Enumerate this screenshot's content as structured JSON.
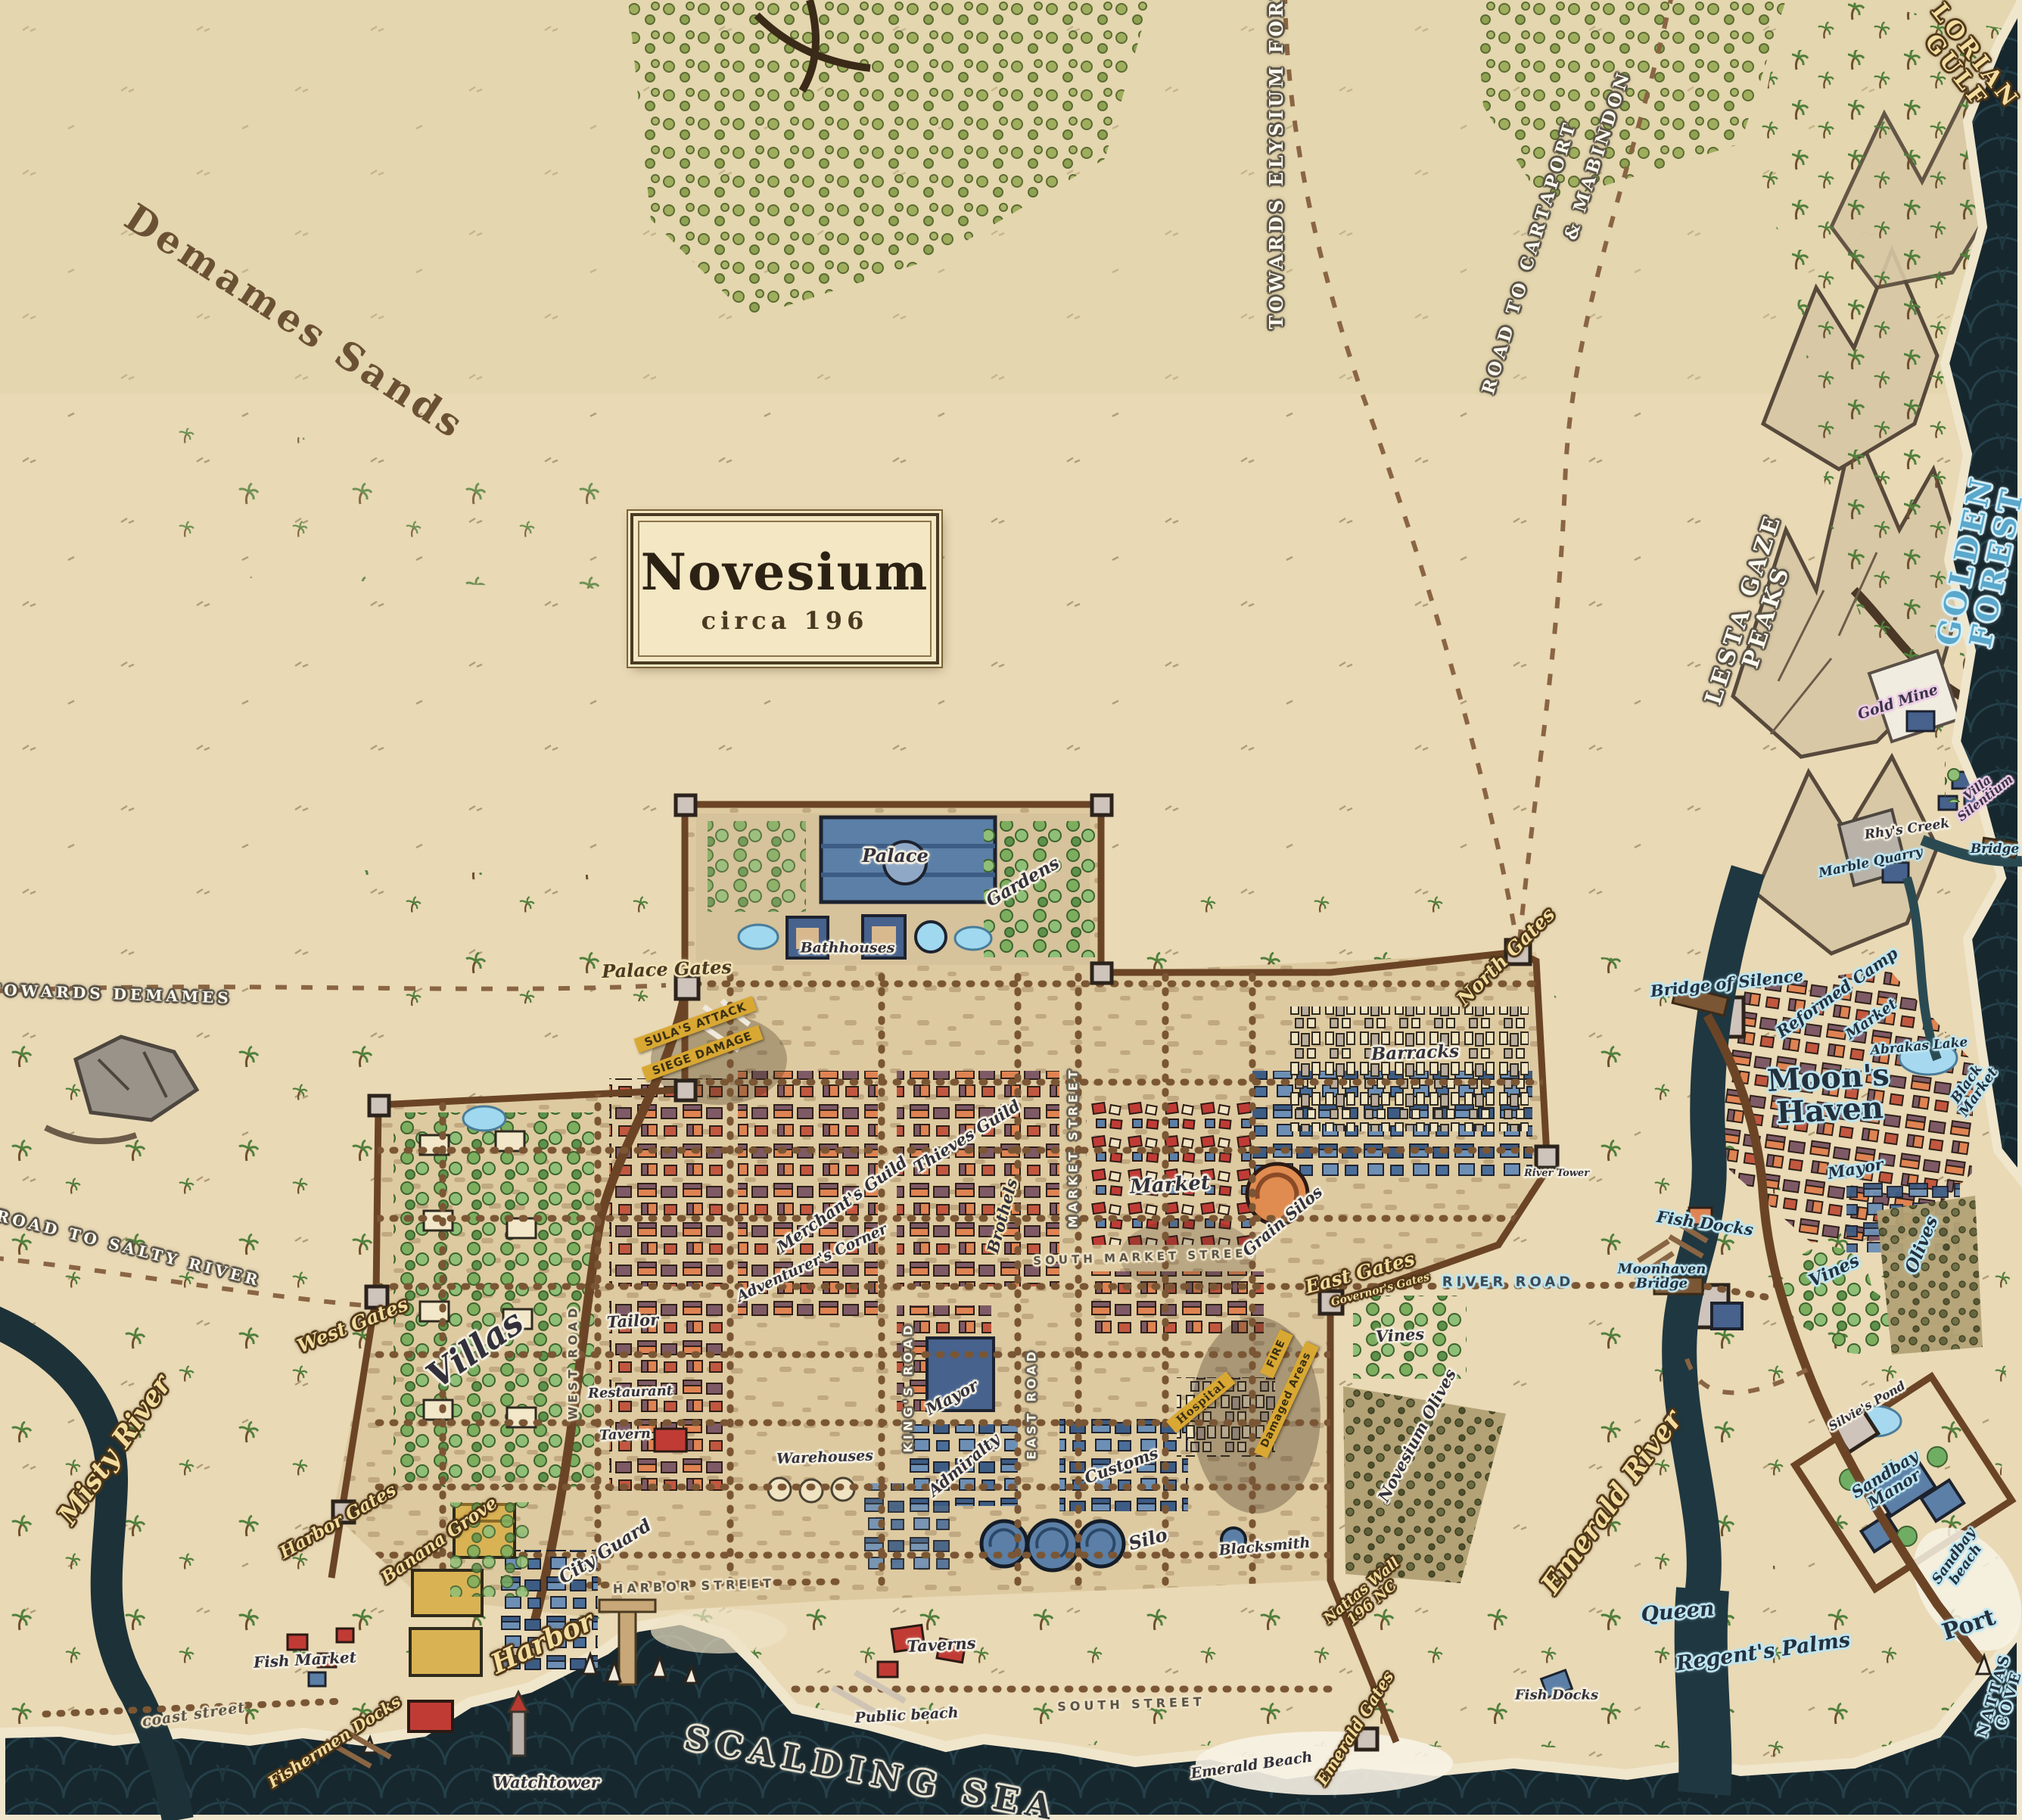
{
  "title": {
    "name": "Novesium",
    "subtitle": "circa 196"
  },
  "labels": {
    "demames_sands": {
      "text": "Demames Sands"
    },
    "lorian_gulf": {
      "text": "LORIAN GULF"
    },
    "towards_elysium": {
      "text": "TOWARDS ELYSIUM FORT"
    },
    "road_cartaport": {
      "text": "ROAD TO CARTAPORT"
    },
    "road_mabindon": {
      "text": "& MABINDON"
    },
    "lesta_gaze_peaks": {
      "text": "LESTA GAZE PEAKS"
    },
    "golden_forest": {
      "text": "GOLDEN FOREST"
    },
    "gold_mine": {
      "text": "Gold Mine"
    },
    "villa_silentium": {
      "text": "Villa Silentium"
    },
    "rhys_creek": {
      "text": "Rhy's Creek"
    },
    "marble_quarry": {
      "text": "Marble Quarry"
    },
    "bridge_ne": {
      "text": "Bridge"
    },
    "bridge_of_silence": {
      "text": "Bridge of Silence"
    },
    "reformed_camp": {
      "text": "Reformed Camp"
    },
    "market_moons_haven": {
      "text": "Market"
    },
    "abrakas_lake": {
      "text": "Abrakas Lake"
    },
    "moons_haven": {
      "text": "Moon's Haven"
    },
    "black_market": {
      "text": "Black Market"
    },
    "river_tower": {
      "text": "River Tower"
    },
    "mayor_moons_haven": {
      "text": "Mayor"
    },
    "fish_docks_east": {
      "text": "Fish Docks"
    },
    "moonhaven_bridge": {
      "text": "Moonhaven\nBridge"
    },
    "vines_moons_haven": {
      "text": "Vines"
    },
    "olives_moons_haven": {
      "text": "Olives"
    },
    "river_road": {
      "text": "RIVER ROAD"
    },
    "silvies_pond": {
      "text": "Silvie's Pond"
    },
    "sandbay_manor": {
      "text": "Sandbay Manor"
    },
    "sandbay_beach": {
      "text": "Sandbay beach"
    },
    "port": {
      "text": "Port"
    },
    "nattas_cove": {
      "text": "NATTAS COVE"
    },
    "emerald_river": {
      "text": "Emerald River"
    },
    "queen_palms_line1": {
      "text": "Queen"
    },
    "queen_palms_line2": {
      "text": "Regent's Palms"
    },
    "fish_docks_south": {
      "text": "Fish Docks"
    },
    "misty_river": {
      "text": "Misty River"
    },
    "road_salty_river": {
      "text": "ROAD TO SALTY RIVER"
    },
    "towards_demames": {
      "text": "TOWARDS DEMAMES"
    },
    "west_gates": {
      "text": "West Gates"
    },
    "harbor_gates": {
      "text": "Harbor Gates"
    },
    "banana_grove": {
      "text": "Banana Grove"
    },
    "fish_market": {
      "text": "Fish Market"
    },
    "coast_street": {
      "text": "coast street"
    },
    "fishermen_docks": {
      "text": "Fishermen Docks"
    },
    "watchtower": {
      "text": "Watchtower"
    },
    "harbor": {
      "text": "Harbor"
    },
    "harbor_street": {
      "text": "HARBOR STREET"
    },
    "city_guard": {
      "text": "City Guard"
    },
    "villas": {
      "text": "Villas"
    },
    "west_road": {
      "text": "WEST ROAD"
    },
    "tailor": {
      "text": "Tailor"
    },
    "restaurant": {
      "text": "Restaurant"
    },
    "tavern": {
      "text": "Tavern"
    },
    "warehouses": {
      "text": "Warehouses"
    },
    "palace_gates": {
      "text": "Palace Gates"
    },
    "sulas_attack": {
      "text": "SULA'S ATTACK"
    },
    "siege_damage": {
      "text": "SIEGE DAMAGE"
    },
    "palace": {
      "text": "Palace"
    },
    "gardens": {
      "text": "Gardens"
    },
    "bathhouses": {
      "text": "Bathhouses"
    },
    "north_gates": {
      "text": "North Gates"
    },
    "barracks": {
      "text": "Barracks"
    },
    "merchants_guild": {
      "text": "Merchant's Guild"
    },
    "adventurers_corner": {
      "text": "Adventurer's Corner"
    },
    "thieves_guild": {
      "text": "Thieves Guild"
    },
    "brothels": {
      "text": "Brothels"
    },
    "market_street": {
      "text": "MARKET STREET"
    },
    "market": {
      "text": "Market"
    },
    "south_market_street": {
      "text": "SOUTH MARKET STREET"
    },
    "grain_silos": {
      "text": "Grain Silos"
    },
    "east_gates": {
      "text": "East Gates"
    },
    "governors_gates": {
      "text": "Governor's Gates"
    },
    "kings_road": {
      "text": "KING'S ROAD"
    },
    "mayor": {
      "text": "Mayor"
    },
    "east_road": {
      "text": "EAST ROAD"
    },
    "admiralty": {
      "text": "Admiralty"
    },
    "customs": {
      "text": "Customs"
    },
    "hospital": {
      "text": "Hospital"
    },
    "fire": {
      "text": "FIRE"
    },
    "damaged_areas": {
      "text": "Damaged Areas"
    },
    "vines_east": {
      "text": "Vines"
    },
    "novesium_olives": {
      "text": "Novesium Olives"
    },
    "silo": {
      "text": "Silo"
    },
    "blacksmith": {
      "text": "Blacksmith"
    },
    "nattas_wall": {
      "text": "Nattas Wall\n196 NC"
    },
    "south_street": {
      "text": "SOUTH STREET"
    },
    "taverns": {
      "text": "Taverns"
    },
    "public_beach": {
      "text": "Public beach"
    },
    "scalding_sea": {
      "text": "SCALDING SEA"
    },
    "emerald_beach": {
      "text": "Emerald Beach"
    },
    "emerald_gates": {
      "text": "Emerald Gates"
    }
  }
}
